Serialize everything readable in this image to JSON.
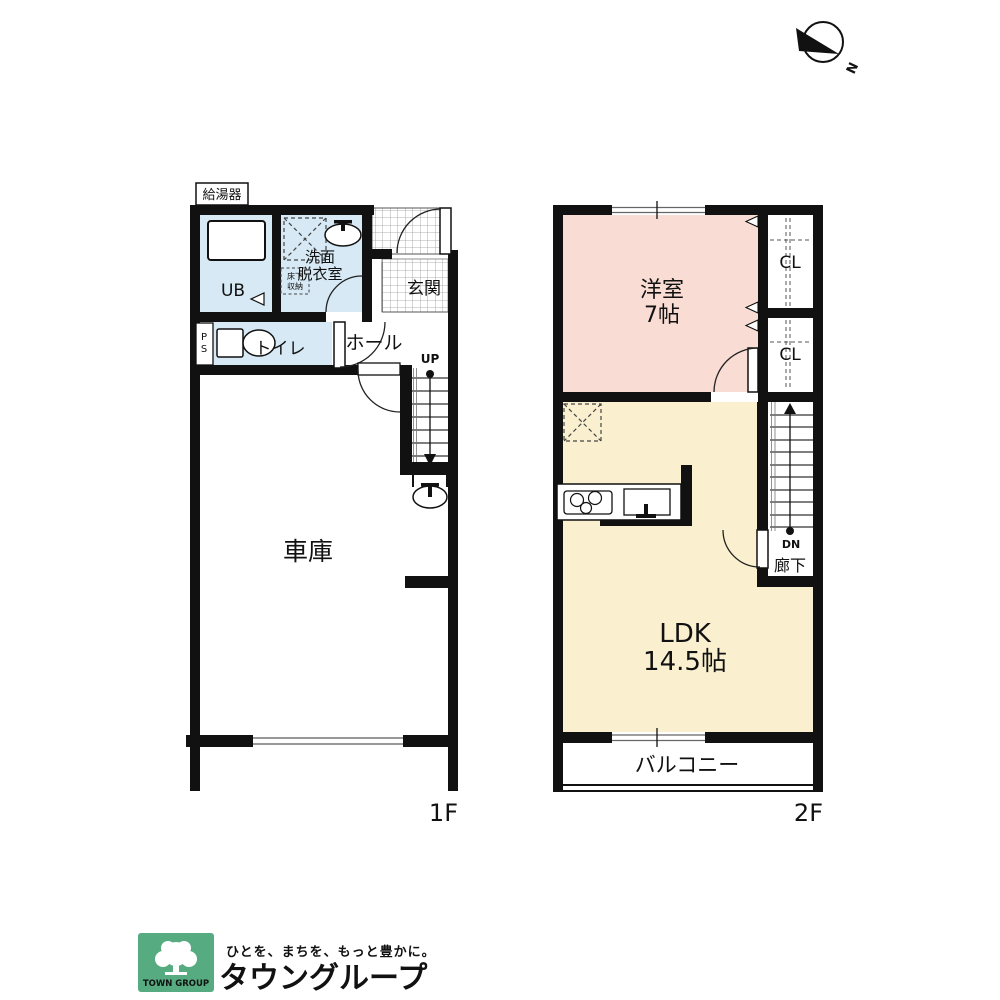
{
  "colors": {
    "wall": "#111111",
    "room_pink": "#f9dcd4",
    "room_cream": "#faf0cf",
    "room_blue": "#d6e9f4",
    "logo_green": "#57ab80"
  },
  "compass": {
    "north_label": "N"
  },
  "floor1": {
    "label": "1F",
    "water_heater": "給湯器",
    "ub": "UB",
    "washroom": [
      "洗面",
      "脱衣室"
    ],
    "underfloor_storage": [
      "床下",
      "収納"
    ],
    "entrance": "玄関",
    "pipe_space": [
      "P",
      "S"
    ],
    "toilet": "トイレ",
    "hall": "ホール",
    "stairs_up": "UP",
    "garage": "車庫"
  },
  "floor2": {
    "label": "2F",
    "western_room": [
      "洋室",
      "7帖"
    ],
    "closet_upper": "CL",
    "closet_lower": "CL",
    "ldk": [
      "LDK",
      "14.5帖"
    ],
    "stairs_down": "DN",
    "corridor": "廊下",
    "balcony": "バルコニー"
  },
  "footer": {
    "logo_name": "TOWN GROUP",
    "tagline": "ひとを、まちを、もっと豊かに。",
    "company": "タウングループ"
  }
}
